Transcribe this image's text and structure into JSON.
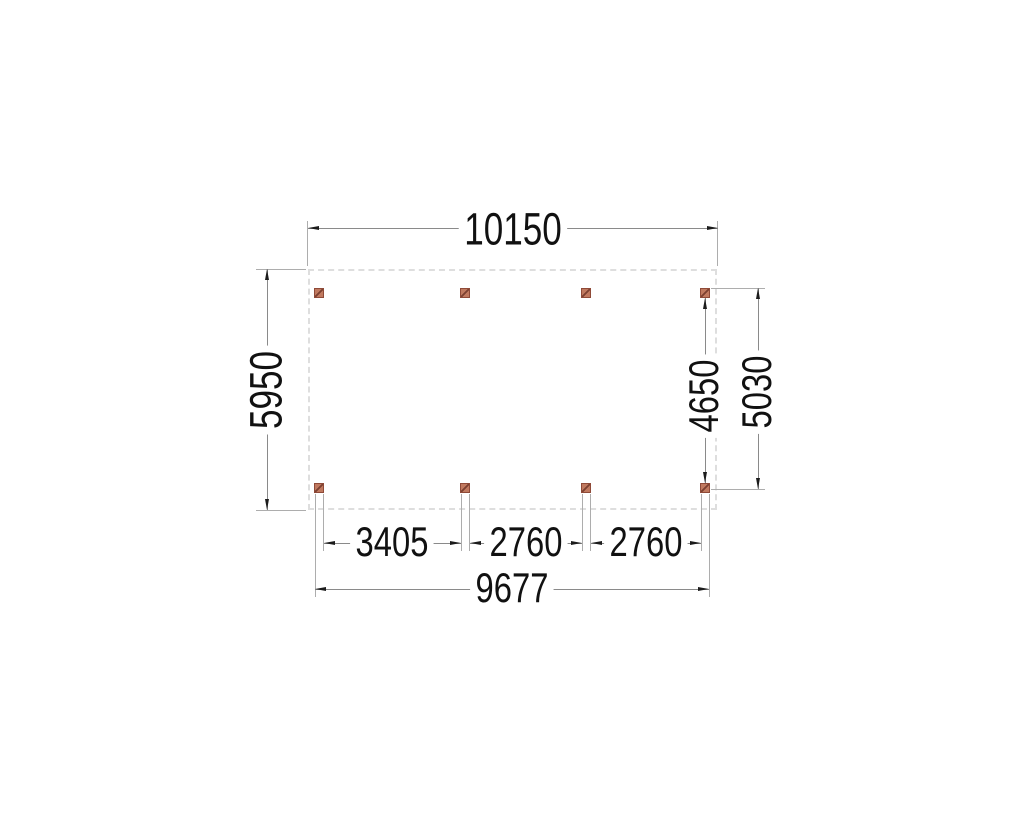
{
  "drawing": {
    "dimensions": {
      "overall_width": "10150",
      "overall_depth": "5950",
      "right_inner_span": "4650",
      "right_outer_span": "5030",
      "bay_left": "3405",
      "bay_middle": "2760",
      "bay_right": "2760",
      "posts_total_span": "9677"
    },
    "posts": {
      "count": 8,
      "rows": 2,
      "columns": 4,
      "symbol": "hatched-square"
    },
    "colors": {
      "background": "#ffffff",
      "outline": "#dedede",
      "dimension_line": "#8a8a8a",
      "extension_line": "#adadad",
      "arrow": "#1c1c1c",
      "text": "#111111",
      "post_fill": "#c0795f",
      "post_border": "#8f4a38"
    }
  }
}
